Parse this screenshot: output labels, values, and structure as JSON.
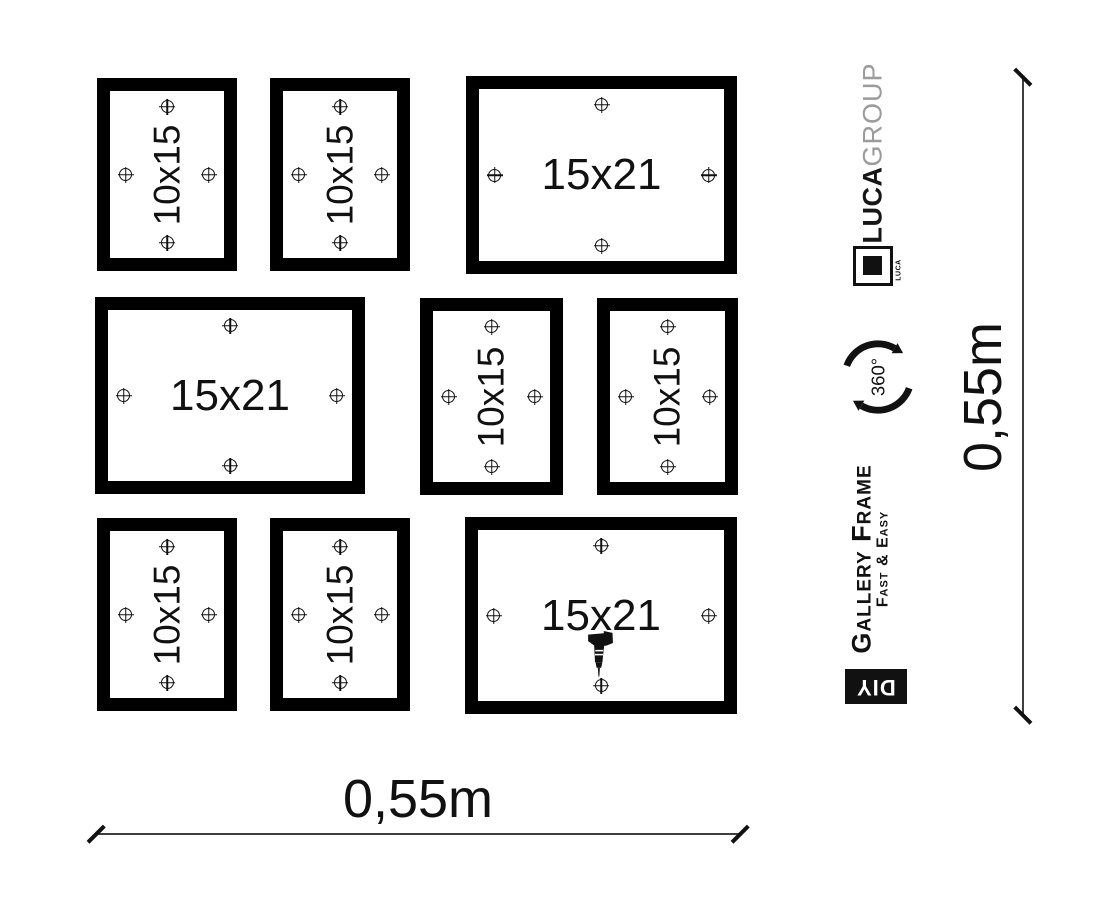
{
  "frames": [
    {
      "label": "10x15"
    },
    {
      "label": "10x15"
    },
    {
      "label": "15x21"
    },
    {
      "label": "15x21"
    },
    {
      "label": "10x15"
    },
    {
      "label": "10x15"
    },
    {
      "label": "10x15"
    },
    {
      "label": "10x15"
    },
    {
      "label": "15x21"
    }
  ],
  "branding": {
    "brand_bold": "LUCA",
    "brand_light": "GROUP",
    "logo_text": "LUCA",
    "rotation_label": "360°",
    "product_name": "Gallery Frame",
    "tagline": "Fast & Easy",
    "diy_label": "DIY"
  },
  "dimensions": {
    "width": "0,55m",
    "height": "0,55m"
  },
  "colors": {
    "background": "#ffffff",
    "frame_black": "#000000",
    "text": "#111111",
    "brand_gray": "#9b9b9b",
    "dimension_line": "#3f3f3f"
  }
}
